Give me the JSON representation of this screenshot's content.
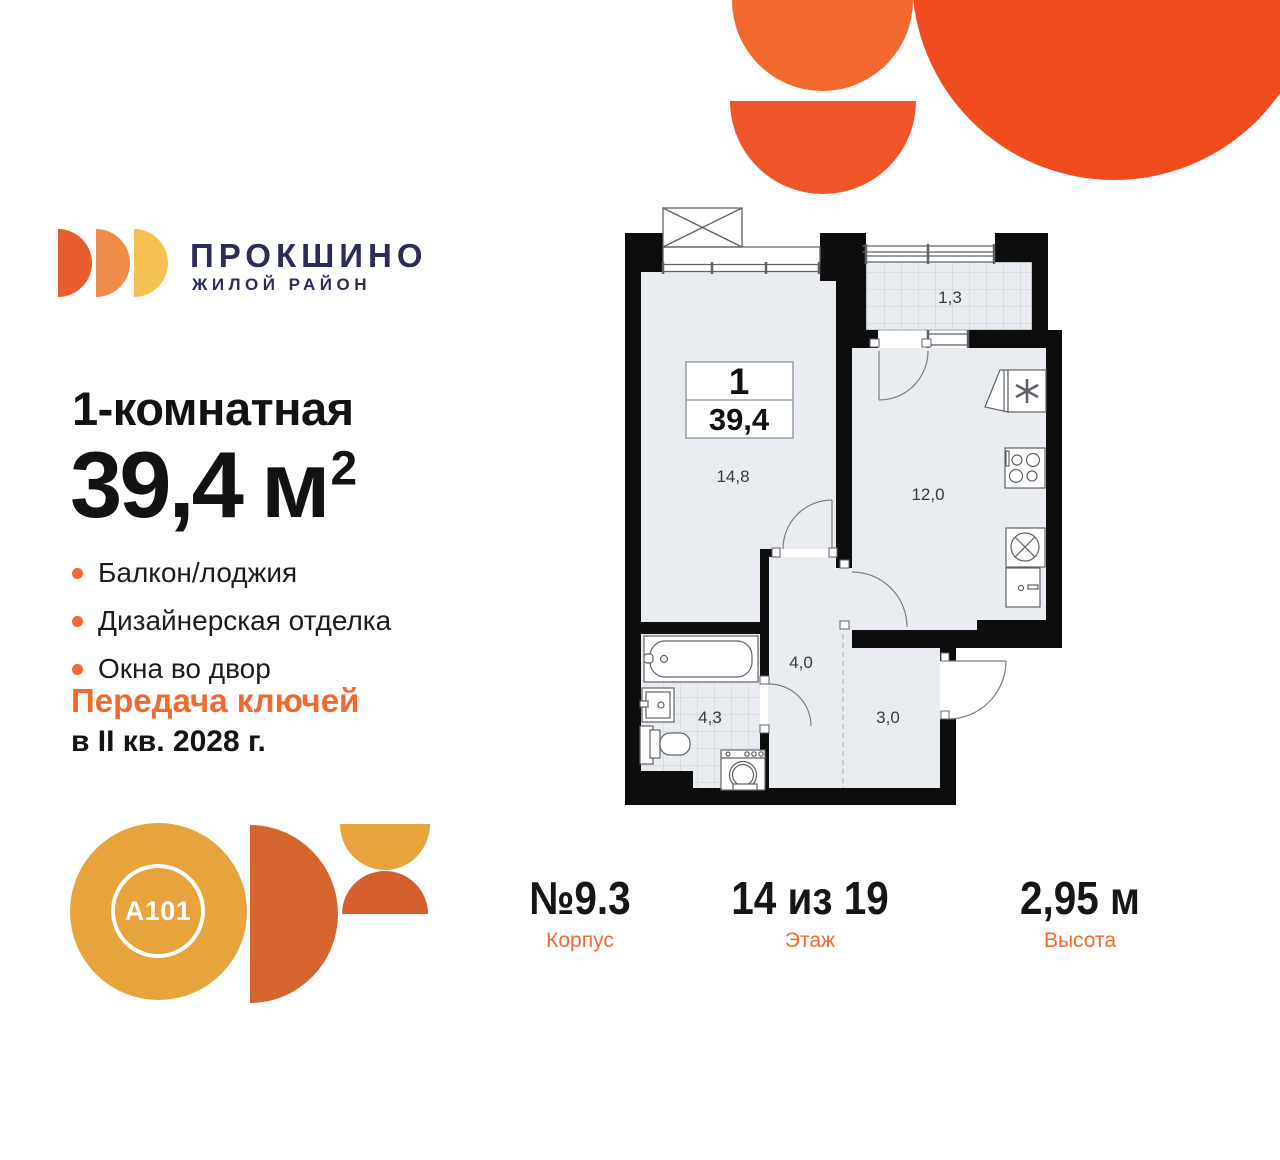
{
  "brand": {
    "logo_name": "ПРОКШИНО",
    "logo_tagline": "ЖИЛОЙ РАЙОН",
    "developer_badge": "A101"
  },
  "colors": {
    "accent_orange": "#F2692F",
    "deep_orange": "#F04C20",
    "navy": "#2B2D58",
    "gold": "#E7A33C",
    "rust": "#D4652F",
    "wall_black": "#0D0D0D",
    "floor_fill": "#E9EDF1"
  },
  "listing": {
    "rooms_title": "1-комнатная",
    "area_value": "39,4",
    "area_unit": "м",
    "area_exponent": "2",
    "features": [
      {
        "label": "Балкон/лоджия"
      },
      {
        "label": "Дизайнерская отделка"
      },
      {
        "label": "Окна во двор"
      }
    ],
    "handover_title": "Передача ключей",
    "handover_term": "в II кв. 2028 г."
  },
  "plan": {
    "info_box": {
      "rooms_count": "1",
      "total_area": "39,4"
    },
    "labels": {
      "living": "14,8",
      "kitchen": "12,0",
      "loggia": "1,3",
      "hallway": "4,0",
      "entry": "3,0",
      "bathroom": "4,3"
    }
  },
  "stats": [
    {
      "value": "№9.3",
      "label": "Корпус"
    },
    {
      "value": "14 из 19",
      "label": "Этаж"
    },
    {
      "value": "2,95 м",
      "label": "Высота"
    }
  ]
}
